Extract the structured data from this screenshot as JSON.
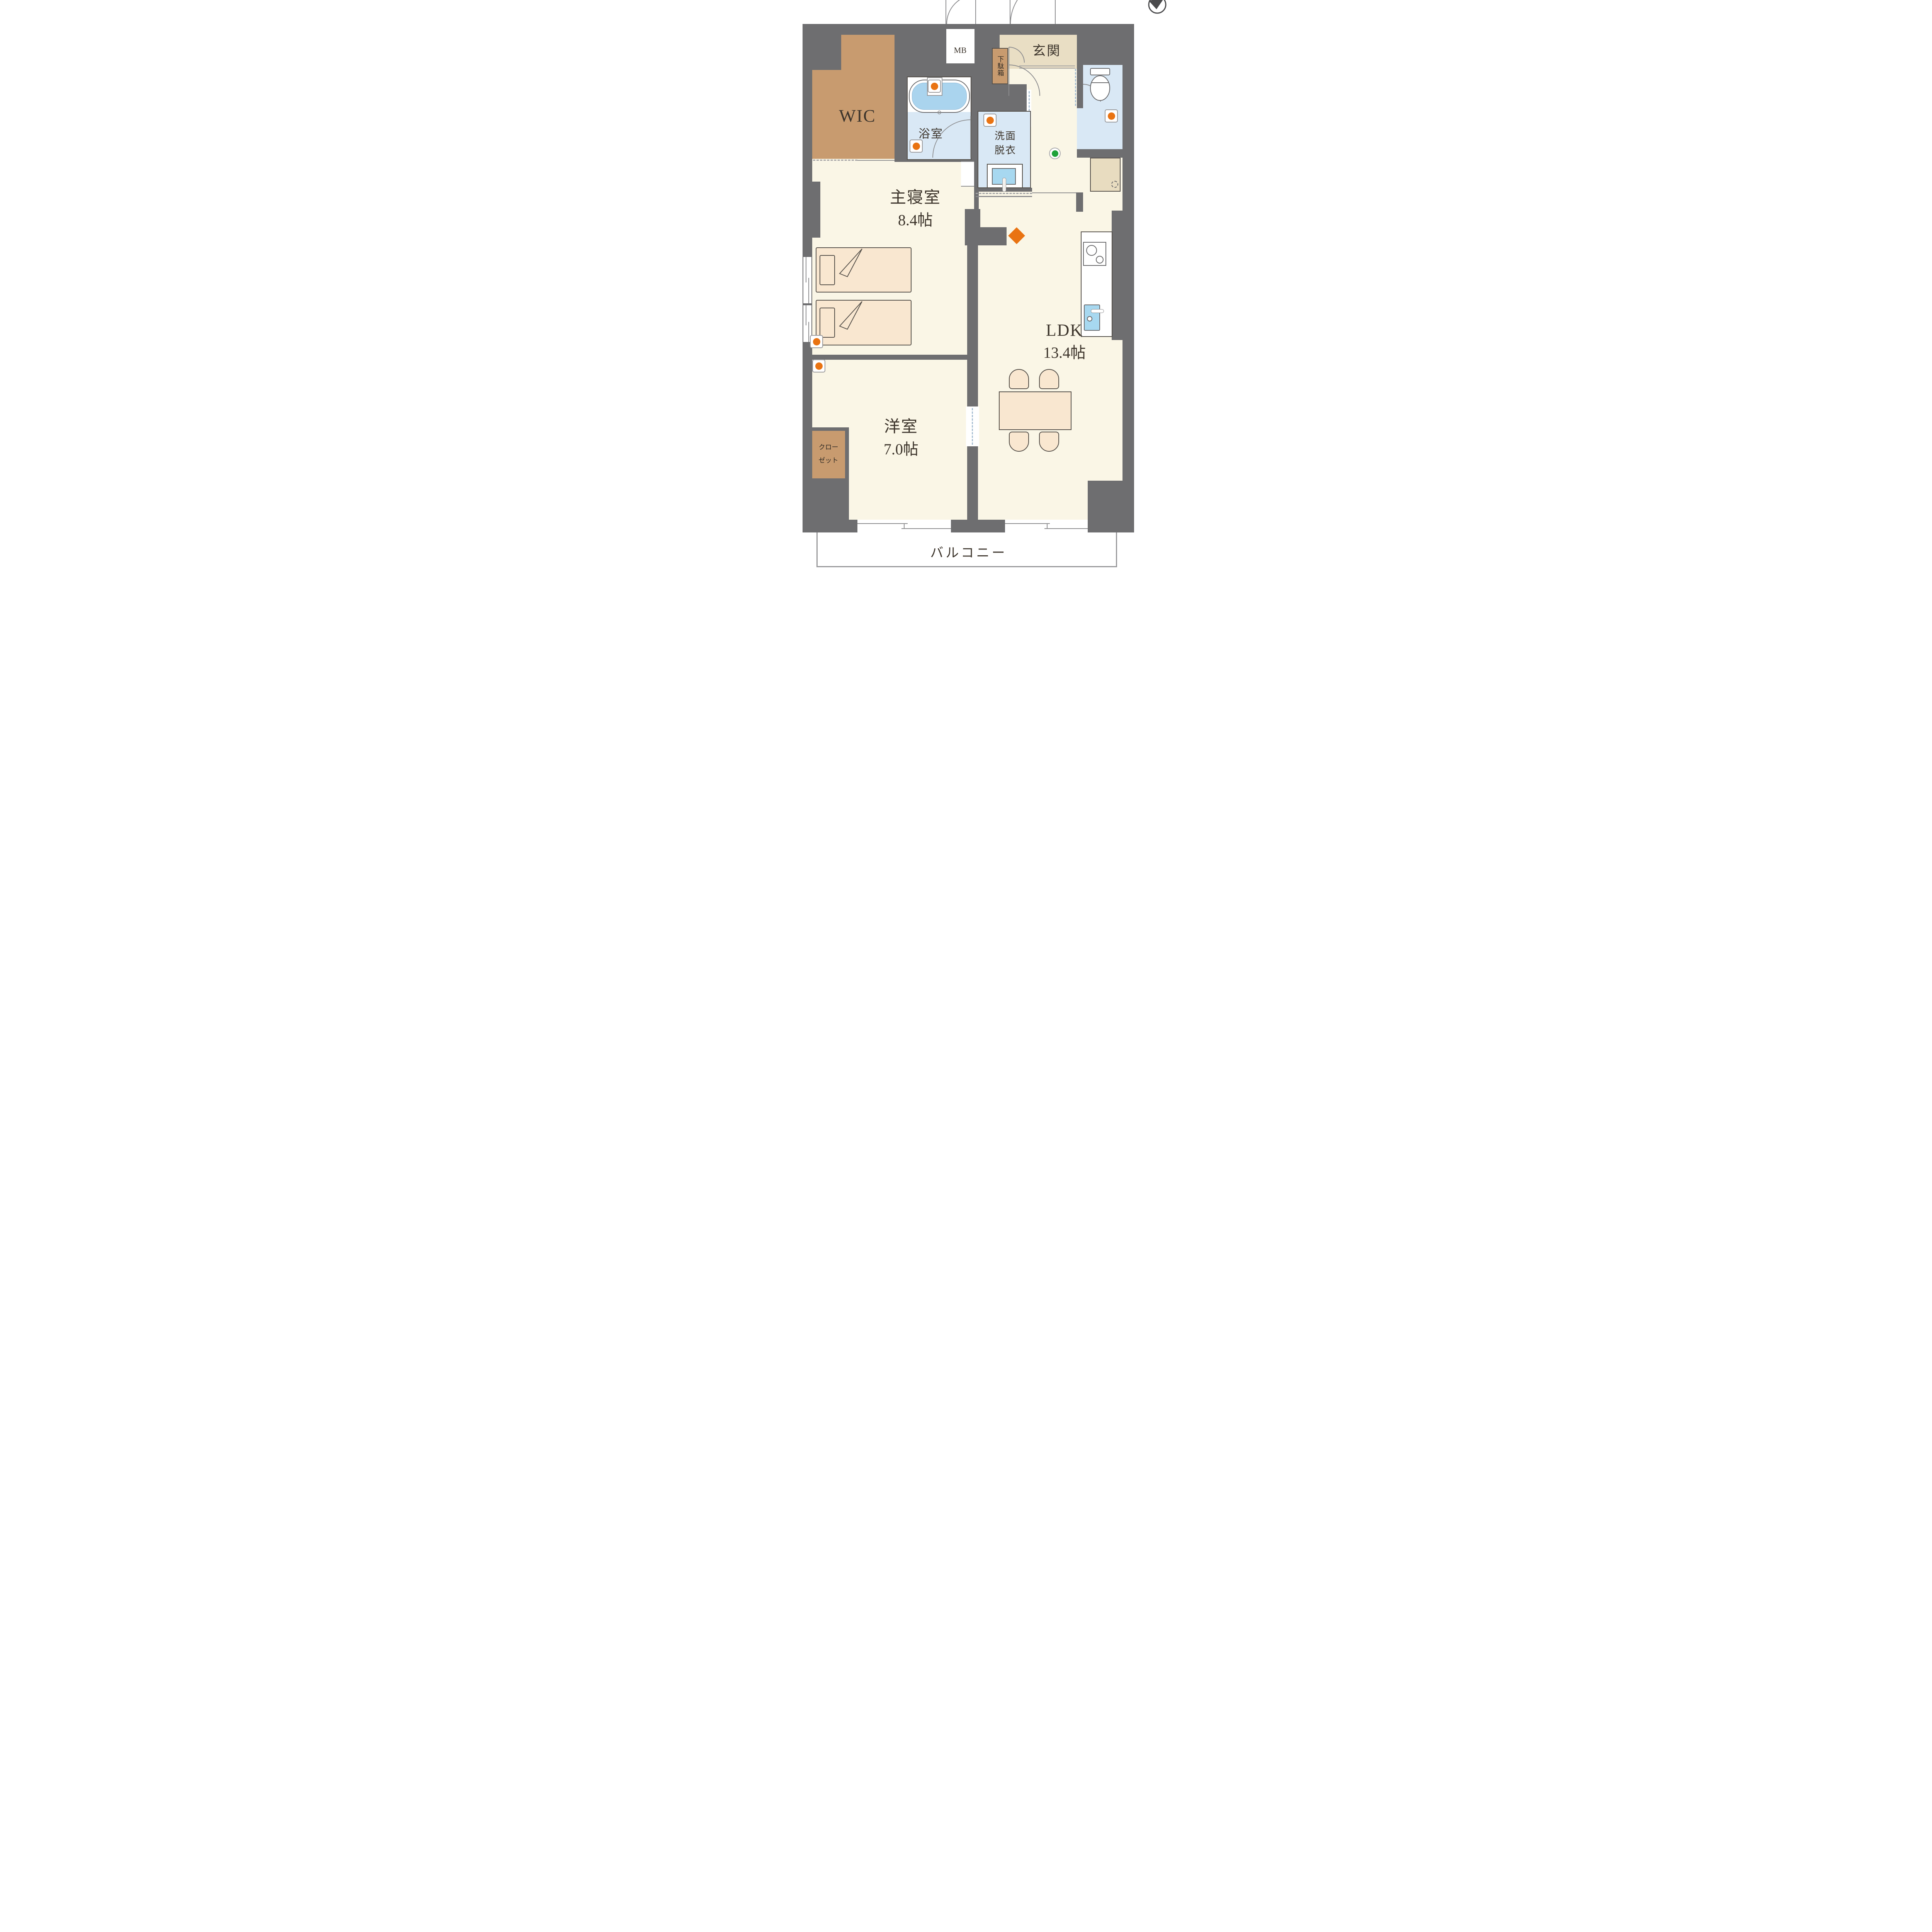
{
  "plan": {
    "type": "apartment-floor-plan",
    "rooms": {
      "wic": {
        "label": "WIC"
      },
      "mb": {
        "label": "MB"
      },
      "entrance": {
        "label": "玄関"
      },
      "shoe_cabinet": {
        "label": "下駄箱"
      },
      "bathroom": {
        "label": "浴室"
      },
      "washroom": {
        "label_line1": "洗面",
        "label_line2": "脱衣"
      },
      "master_bedroom": {
        "label": "主寝室",
        "size": "8.4帖"
      },
      "ldk": {
        "label": "LDK",
        "size": "13.4帖"
      },
      "western_room": {
        "label": "洋室",
        "size": "7.0帖"
      },
      "closet": {
        "label_line1": "クロー",
        "label_line2": "ゼット"
      },
      "balcony": {
        "label": "バルコニー"
      }
    },
    "icons": {
      "compass": "north-arrow",
      "orange_sensor_count": 6,
      "green_sensor_count": 1,
      "orange_diamond_count": 1
    },
    "colors": {
      "wall": "#6e6e70",
      "floor": "#faf6e6",
      "entrance_beige": "#e9dec4",
      "closet_brown": "#c89b6f",
      "wet_area_blue": "#d9e8f5",
      "tub_water": "#aad4ee",
      "sink_blue": "#a7d8f0",
      "furniture": "#f9e7d0",
      "accent_orange": "#e97312",
      "accent_green": "#1ea23a"
    }
  }
}
